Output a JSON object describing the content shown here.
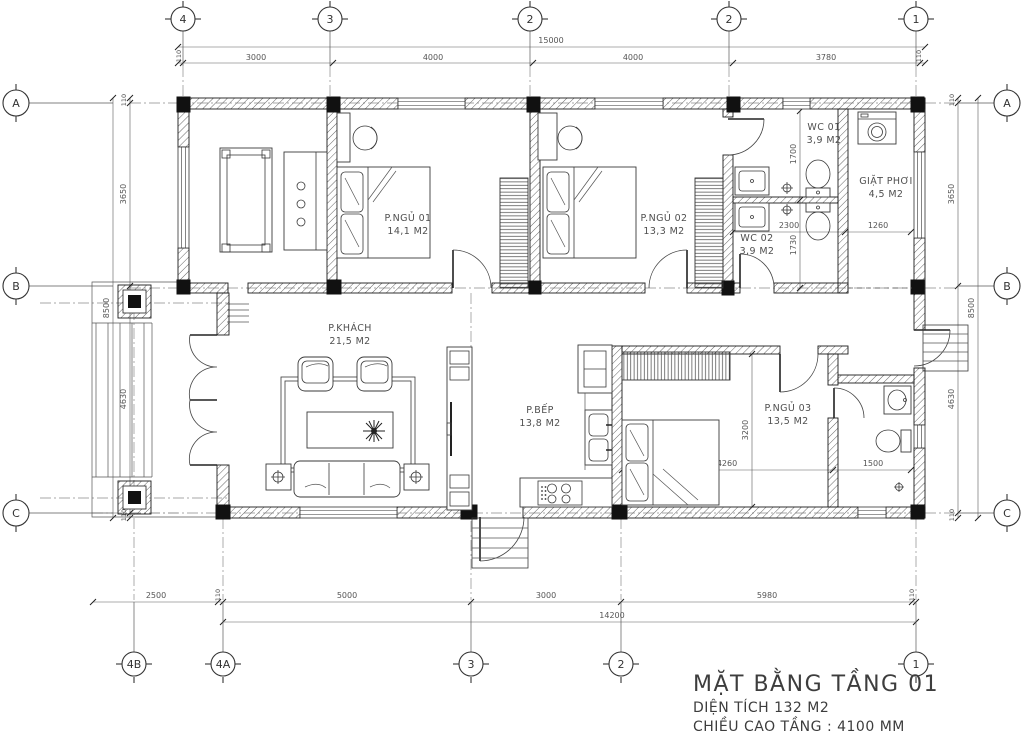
{
  "drawing": {
    "title": "MẶT BẰNG TẦNG 01",
    "subtitle_area": "DIỆN TÍCH 132 M2",
    "subtitle_height": "CHIỀU CAO TẦNG : 4100 MM"
  },
  "grid": {
    "top": [
      "4",
      "3",
      "2",
      "2",
      "1"
    ],
    "bottom": [
      "4B",
      "4A",
      "3",
      "2",
      "1"
    ],
    "left": [
      "A",
      "B",
      "C"
    ],
    "right": [
      "A",
      "B",
      "C"
    ]
  },
  "dims": {
    "top_total": "15000",
    "top": [
      "110",
      "3000",
      "4000",
      "4000",
      "3780",
      "110"
    ],
    "bottom": [
      "2500",
      "110",
      "5000",
      "3000",
      "5980",
      "110"
    ],
    "bottom_total": "14200",
    "side": [
      "110",
      "3650",
      "4630",
      "110"
    ],
    "side_total": "8500",
    "interior": {
      "wc_upper": "1700",
      "wc_width": "2300",
      "wc_lower": "1730",
      "laundry": "1260",
      "bed3_w": "4260",
      "bed3_h": "3200",
      "bath3_w": "1500"
    }
  },
  "rooms": [
    {
      "name": "P.NGỦ 01",
      "area": "14,1 M2"
    },
    {
      "name": "P.NGỦ 02",
      "area": "13,3 M2"
    },
    {
      "name": "WC 01",
      "area": "3,9 M2"
    },
    {
      "name": "GIẶT PHƠI",
      "area": "4,5 M2"
    },
    {
      "name": "WC 02",
      "area": "3,9 M2"
    },
    {
      "name": "P.KHÁCH",
      "area": "21,5 M2"
    },
    {
      "name": "P.BẾP",
      "area": "13,8 M2"
    },
    {
      "name": "P.NGỦ 03",
      "area": "13,5 M2"
    }
  ]
}
